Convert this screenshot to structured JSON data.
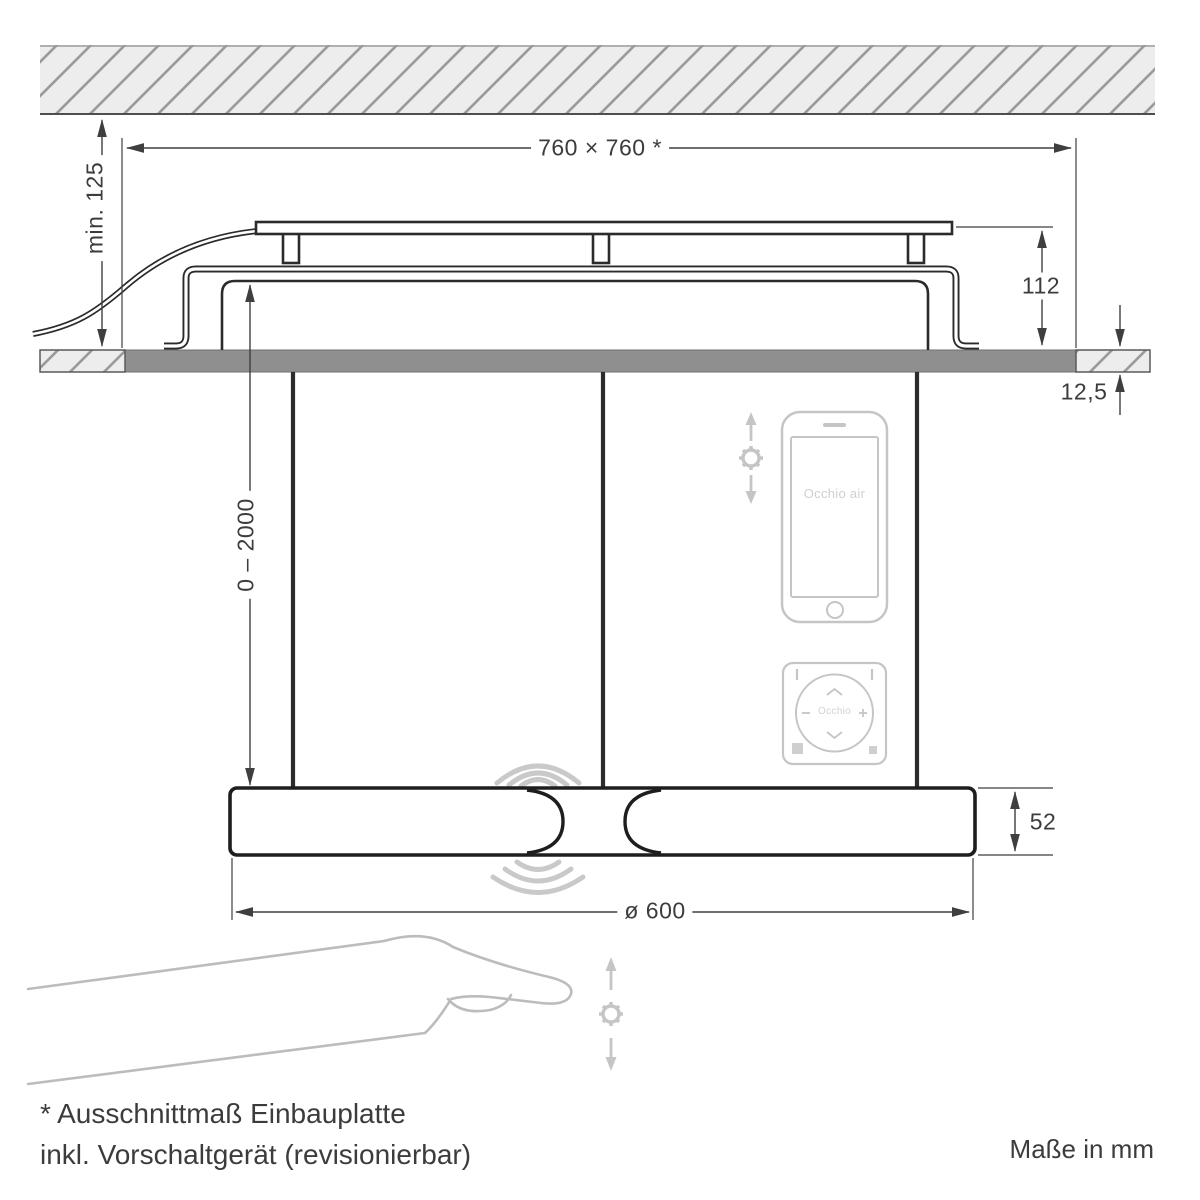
{
  "drawing": {
    "dimensions": {
      "cutout": "760 × 760 *",
      "min_clearance": "min. 125",
      "housing_height": "112",
      "panel_thickness": "12,5",
      "suspension_range": "0 – 2000",
      "body_height": "52",
      "diameter": "ø 600"
    },
    "phone": {
      "label": "Occhio air"
    },
    "remote": {
      "label": "Occhio"
    },
    "footnote": {
      "line1": "* Ausschnittmaß Einbauplatte",
      "line2": "inkl. Vorschaltgerät (revisionierbar)"
    },
    "units_note": "Maße in mm",
    "colors": {
      "line": "#2b2b2b",
      "dimension": "#3f3f3f",
      "text": "#3c3c3c",
      "panel_gray": "#8f8f8f",
      "hatch_fill": "#ededed",
      "hatch_stroke": "#9a9a9a",
      "icon_gray": "#c5c5c5",
      "hand_gray": "#bcbcbc"
    }
  }
}
